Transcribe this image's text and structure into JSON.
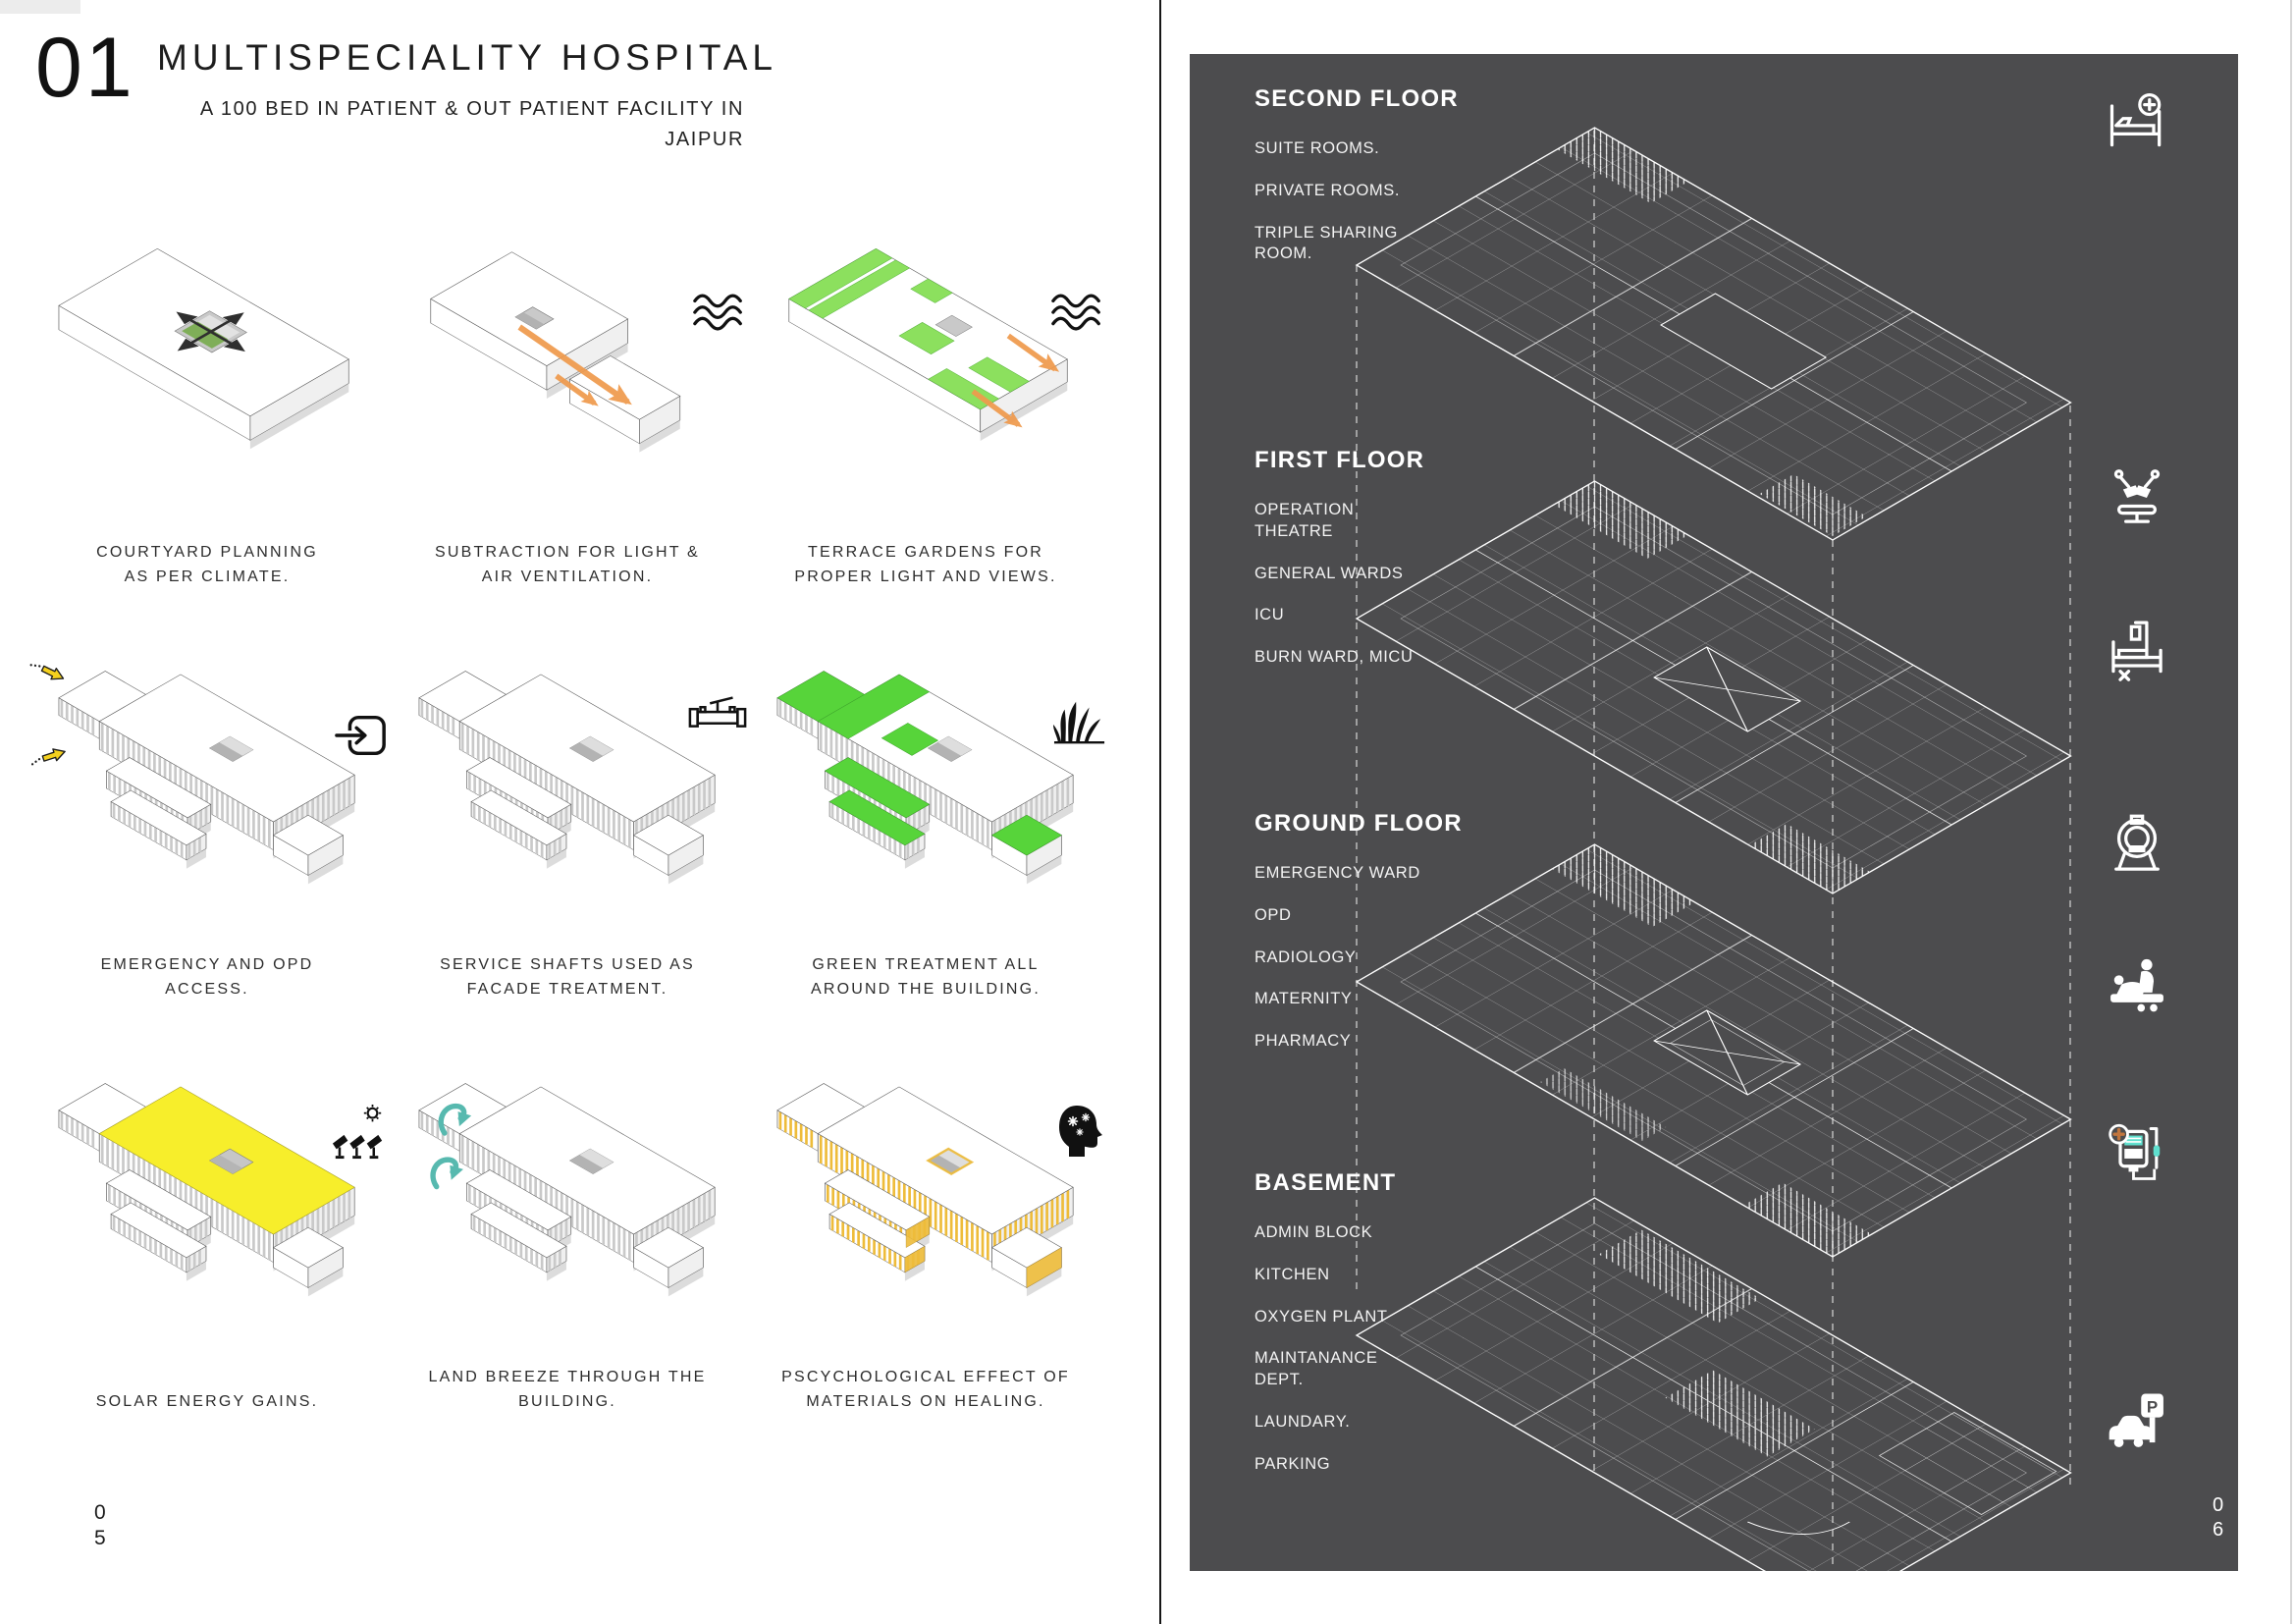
{
  "page_left": {
    "index_number": "01",
    "title": "MULTISPECIALITY HOSPITAL",
    "subtitle_line1": "A 100 BED IN PATIENT & OUT PATIENT FACILITY IN",
    "subtitle_line2": "JAIPUR",
    "page_number": {
      "top": "0",
      "bottom": "5"
    },
    "diagrams": [
      {
        "id": "courtyard-planning",
        "caption1": "COURTYARD PLANNING",
        "caption2": "AS PER CLIMATE.",
        "icon": null
      },
      {
        "id": "subtraction",
        "caption1": "SUBTRACTION FOR LIGHT &",
        "caption2": "AIR VENTILATION.",
        "icon": "air-waves"
      },
      {
        "id": "terrace-gardens",
        "caption1": "TERRACE GARDENS FOR",
        "caption2": "PROPER LIGHT AND VIEWS.",
        "icon": "air-waves"
      },
      {
        "id": "emergency-opd",
        "caption1": "EMERGENCY AND OPD",
        "caption2": "ACCESS.",
        "icon": "entry-arrow"
      },
      {
        "id": "service-shafts",
        "caption1": "SERVICE SHAFTS USED AS",
        "caption2": "FACADE TREATMENT.",
        "icon": "pipe-valve"
      },
      {
        "id": "green-treatment",
        "caption1": "GREEN TREATMENT ALL",
        "caption2": "AROUND THE BUILDING.",
        "icon": "grass"
      },
      {
        "id": "solar-gains",
        "caption1": "SOLAR ENERGY GAINS.",
        "caption2": "",
        "icon": "sun-solar-panels"
      },
      {
        "id": "land-breeze",
        "caption1": "LAND BREEZE THROUGH THE",
        "caption2": "BUILDING.",
        "icon": null
      },
      {
        "id": "materials-healing",
        "caption1": "PSCYCHOLOGICAL EFFECT OF",
        "caption2": "MATERIALS ON HEALING.",
        "icon": "healing-mind"
      }
    ]
  },
  "page_right": {
    "panel_color": "#4c4c4e",
    "floors": [
      {
        "title": "SECOND FLOOR",
        "items": [
          "SUITE ROOMS.",
          "PRIVATE ROOMS.",
          "TRIPLE SHARING ROOM."
        ]
      },
      {
        "title": "FIRST FLOOR",
        "items": [
          "OPERATION THEATRE",
          "GENERAL WARDS",
          "ICU",
          "BURN WARD, MICU"
        ]
      },
      {
        "title": "GROUND FLOOR",
        "items": [
          "EMERGENCY WARD",
          "OPD",
          "RADIOLOGY",
          "MATERNITY",
          "PHARMACY"
        ]
      },
      {
        "title": "BASEMENT",
        "items": [
          "ADMIN BLOCK",
          "KITCHEN",
          "OXYGEN PLANT",
          "MAINTANANCE DEPT.",
          "LAUNDARY.",
          "PARKING"
        ]
      }
    ],
    "icons": [
      "hospital-bed-plus",
      "operation-theatre-light",
      "icu-bed",
      "mri-scanner",
      "maternity-care",
      "infusion-pump",
      "car-parking"
    ],
    "parking_letter": "P",
    "page_number": {
      "top": "0",
      "bottom": "6"
    }
  },
  "colors": {
    "panel": "#4c4c4e",
    "green_bright": "#57d43a",
    "green_light": "#8ce05e",
    "green_muted": "#7fae58",
    "yellow_roof": "#f7ee2b",
    "amber_fins": "#eebc3a",
    "orange_arrow": "#ef9a4d",
    "yellow_arrow": "#f4d01e",
    "teal_arrow": "#57b9af"
  }
}
